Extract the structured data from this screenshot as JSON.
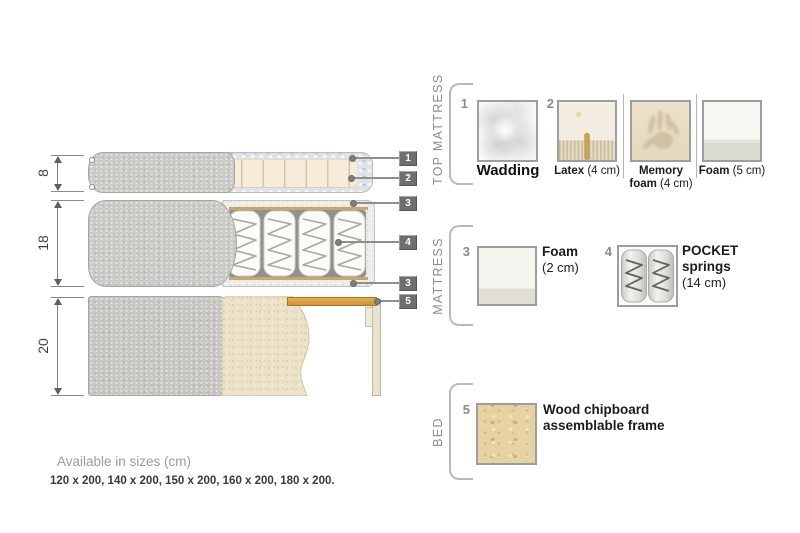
{
  "diagram": {
    "dimensions": [
      {
        "label": "8"
      },
      {
        "label": "18"
      },
      {
        "label": "20"
      }
    ],
    "markers": [
      {
        "num": "1"
      },
      {
        "num": "2"
      },
      {
        "num": "3"
      },
      {
        "num": "4"
      },
      {
        "num": "3"
      },
      {
        "num": "5"
      }
    ]
  },
  "legend": {
    "groups": [
      {
        "title": "TOP MATTRESS"
      },
      {
        "title": "MATTRESS"
      },
      {
        "title": "BED"
      }
    ],
    "items": {
      "wadding": {
        "num": "1",
        "name": "Wadding"
      },
      "latex": {
        "num": "2",
        "name": "Latex",
        "detail": "(4 cm)"
      },
      "memory": {
        "name": "Memory foam",
        "detail": "(4 cm)"
      },
      "foam5": {
        "name": "Foam",
        "detail": "(5 cm)"
      },
      "foam2": {
        "num": "3",
        "name": "Foam",
        "detail": "(2 cm)"
      },
      "pocket": {
        "num": "4",
        "name": "POCKET springs",
        "detail": "(14 cm)"
      },
      "wood": {
        "num": "5",
        "name": "Wood chipboard assemblable frame"
      }
    }
  },
  "footer": {
    "heading": "Available in sizes (cm)",
    "sizes": "120 x 200, 140 x 200, 150 x 200, 160 x 200, 180 x 200."
  },
  "colors": {
    "marker_chip": "#6f6f6f",
    "cover_gray": "#cbcac6",
    "foam_cream": "#f7ecda",
    "wadding_blue_gray": "#dfe3e7",
    "wood_slat": "#d89a3f",
    "chipboard_tan": "#e6d2a2"
  }
}
